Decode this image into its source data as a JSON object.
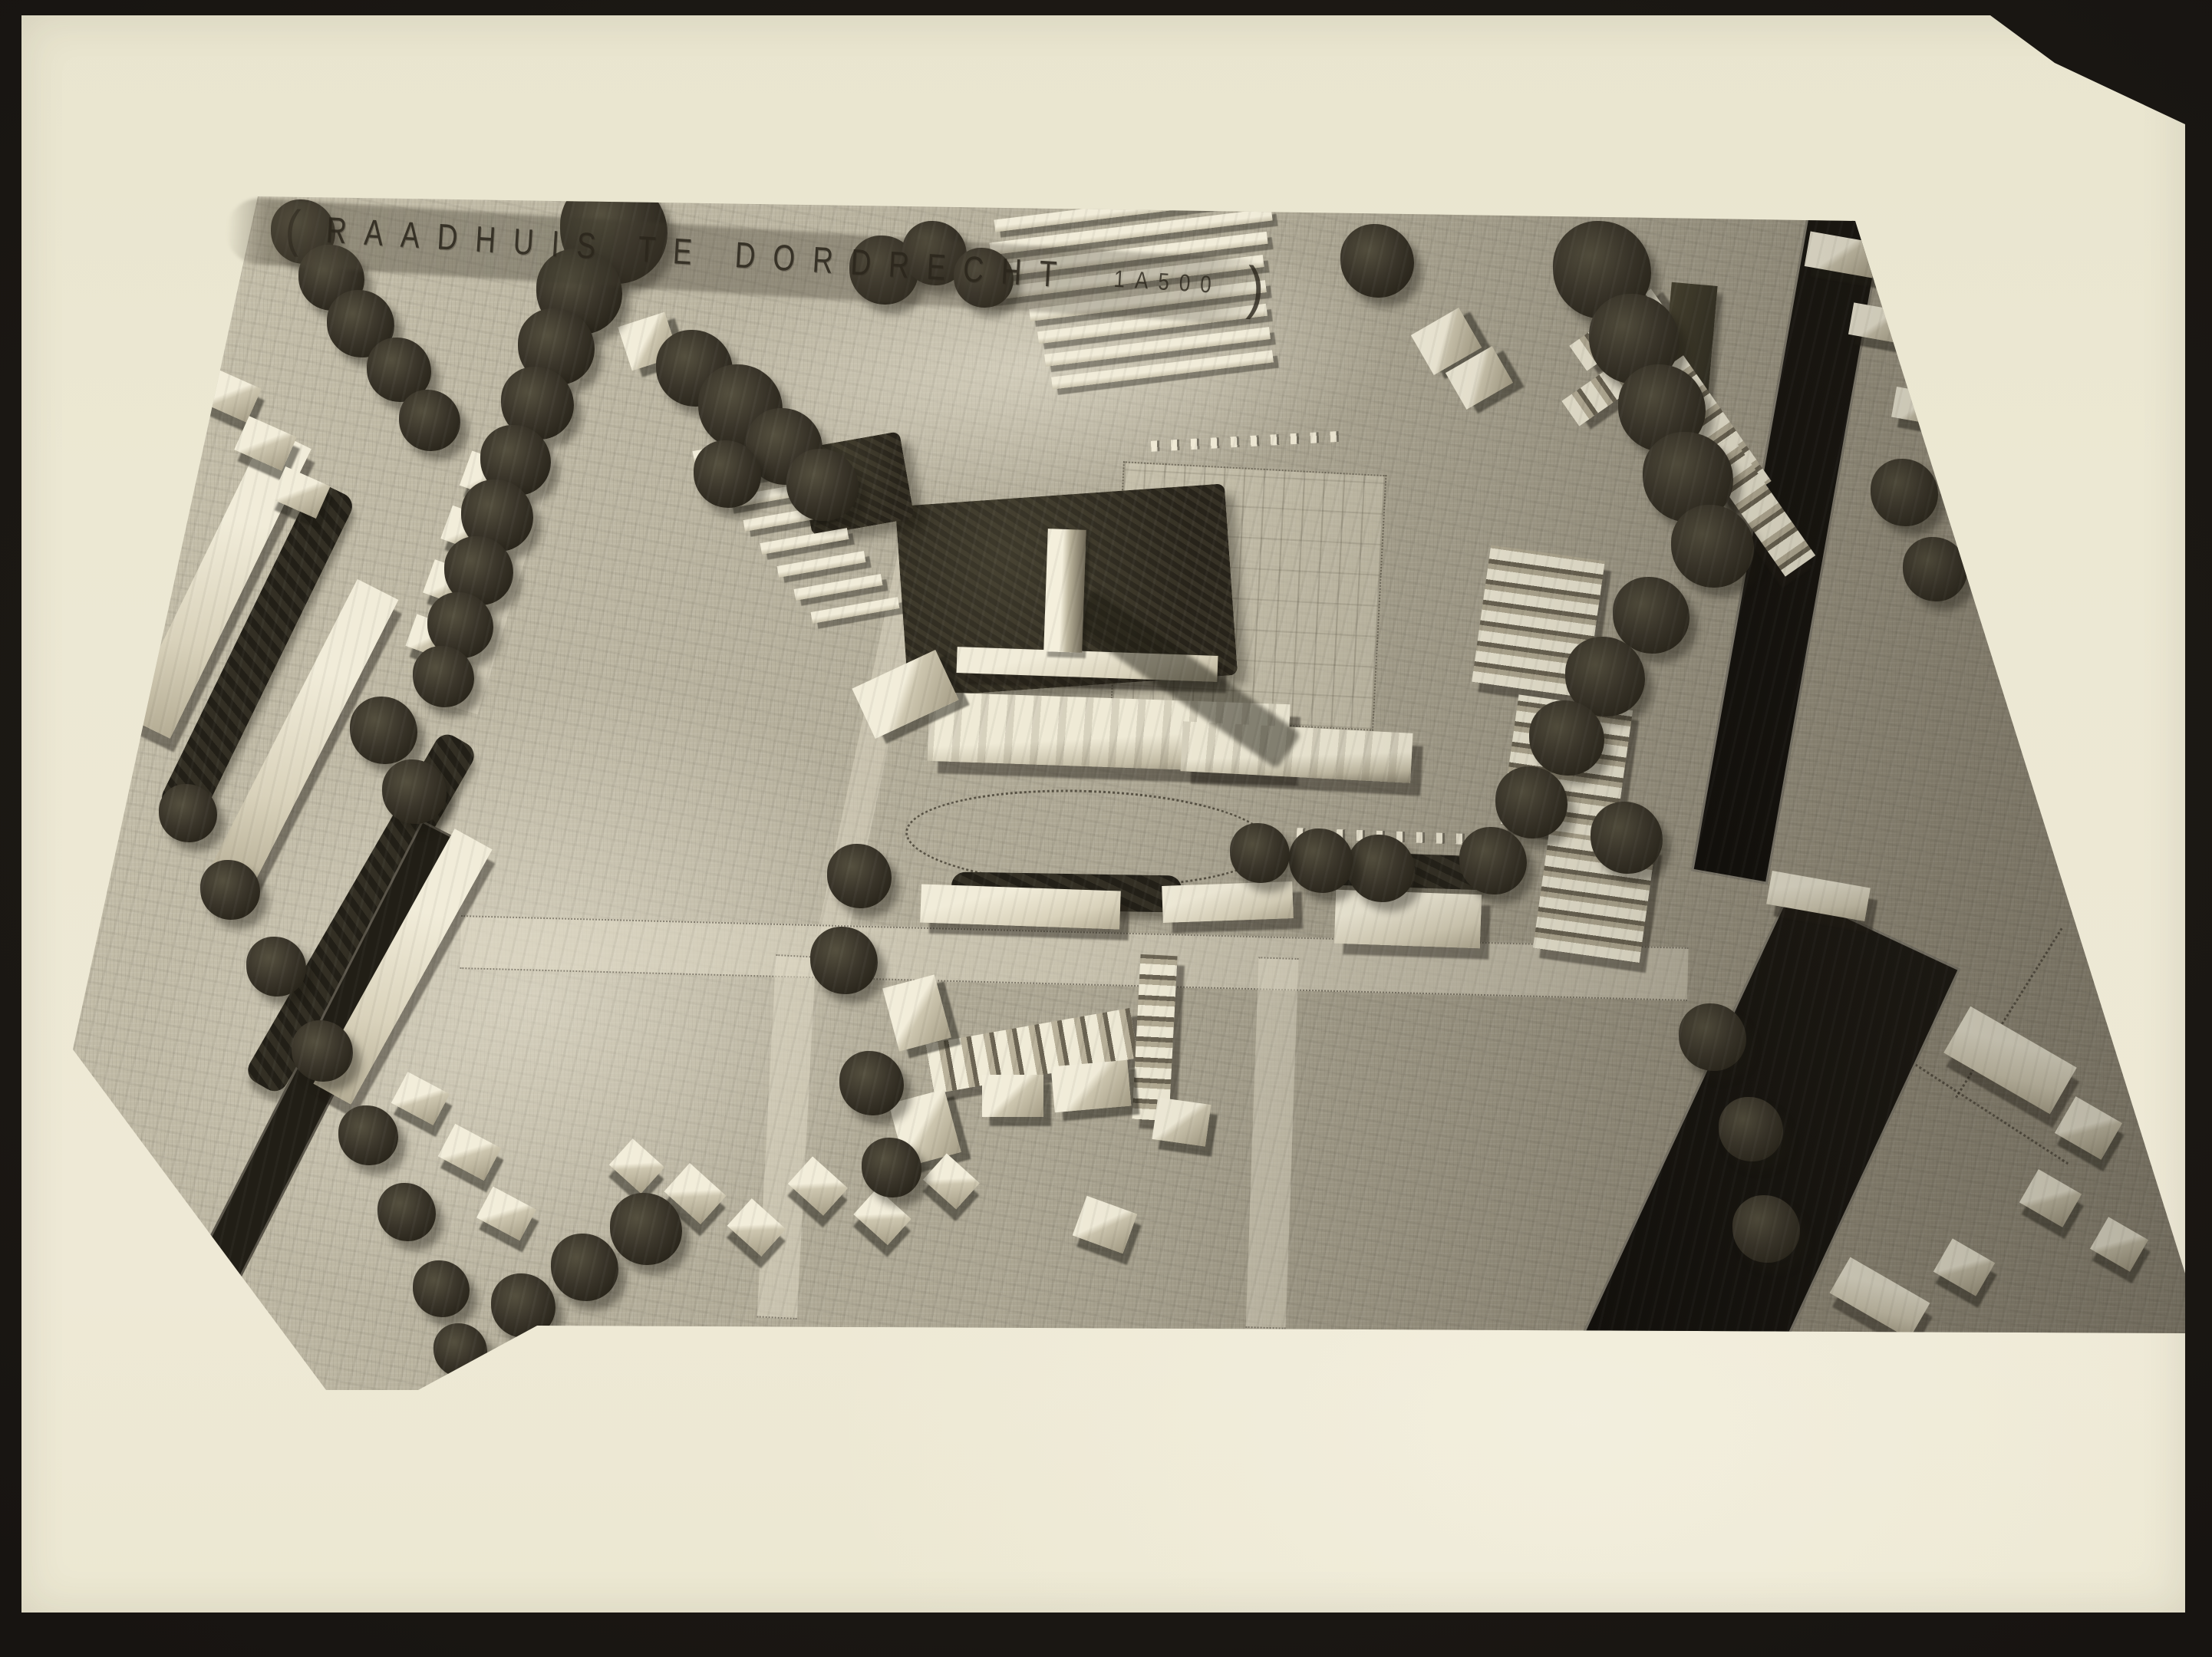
{
  "photo": {
    "kind": "black-and-white photograph of an architectural scale model (aerial view of town plan maquette)",
    "title": {
      "open_paren": "(",
      "text": "RAADHUIS TE DORDRECHT",
      "scale_label": "1A500",
      "close_paren": ")"
    }
  },
  "palette": {
    "backing": "#171411",
    "backing_hi": "#242019",
    "paper_cream": "#ece8d3",
    "board_light": "#c9c3ae",
    "board_dark": "#8b8474",
    "building_light": "#f1ecd9",
    "building_shade": "#6b6453",
    "tree_dark": "#3a352a",
    "water_dark": "#16130e",
    "ink": "#2b261c"
  }
}
